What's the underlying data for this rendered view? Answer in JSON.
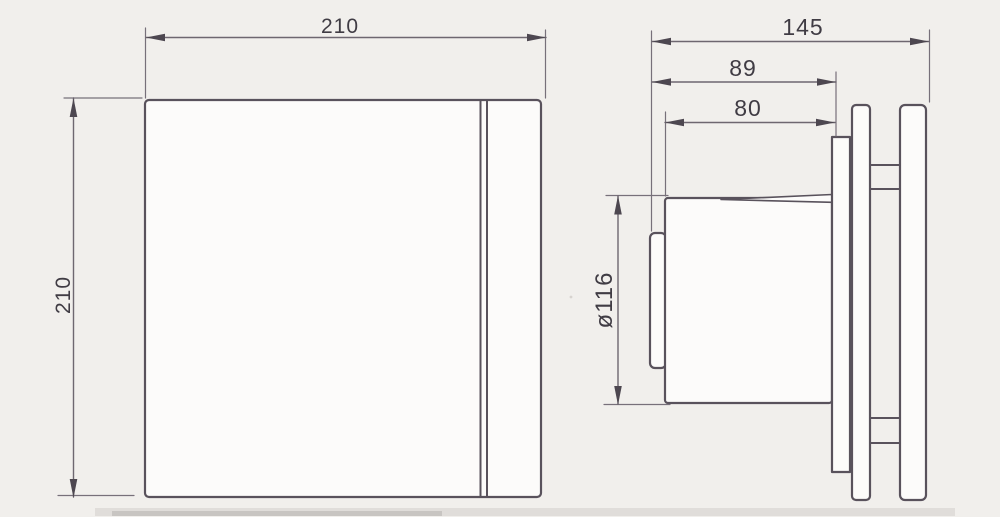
{
  "document": {
    "type": "technical-drawing",
    "subject": "extractor-fan-dimensional-diagram",
    "units": "mm"
  },
  "colors": {
    "background": "#f1efec",
    "object_line": "#59525c",
    "dimension_line": "#6e6770",
    "text": "#403c44"
  },
  "views": {
    "front": {
      "name": "front view",
      "dimensions": {
        "width": {
          "label": "210",
          "value_mm": 210,
          "orientation": "horizontal"
        },
        "height": {
          "label": "210",
          "value_mm": 210,
          "orientation": "vertical"
        }
      }
    },
    "side": {
      "name": "side view",
      "dimensions": {
        "overall_depth": {
          "label": "145",
          "value_mm": 145,
          "orientation": "horizontal"
        },
        "flange_depth": {
          "label": "89",
          "value_mm": 89,
          "orientation": "horizontal"
        },
        "body_depth": {
          "label": "80",
          "value_mm": 80,
          "orientation": "horizontal"
        },
        "duct_diameter": {
          "label": "ø116",
          "value_mm": 116,
          "orientation": "vertical"
        }
      }
    }
  }
}
